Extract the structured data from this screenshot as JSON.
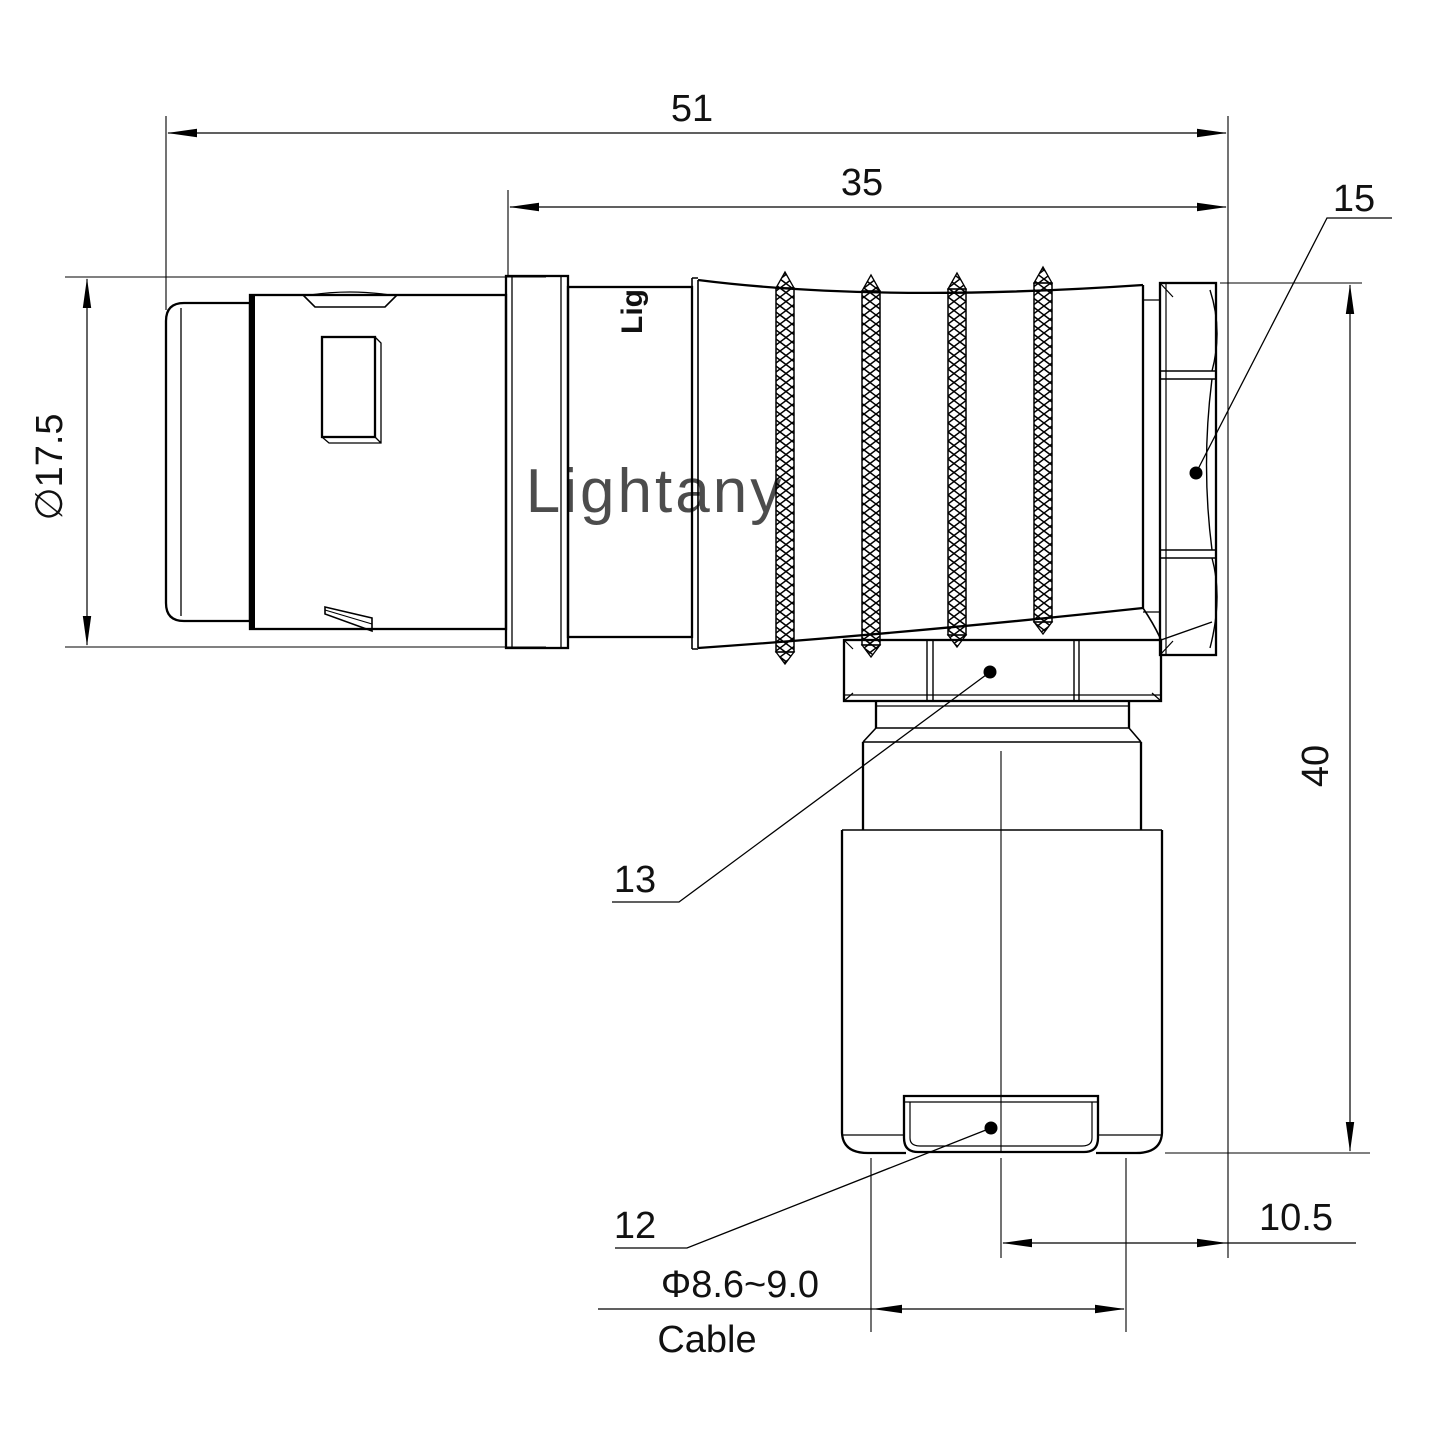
{
  "title": "Right-angle circular connector technical drawing",
  "watermark": "Lightany",
  "body_marking": "Lig",
  "dimensions": {
    "overall_length": "51",
    "rear_length": "35",
    "shell_diameter": "∅17.5",
    "height": "40",
    "axis_offset": "10.5",
    "cable_diameter": "Φ8.6~9.0",
    "cable_caption": "Cable"
  },
  "callouts": {
    "backnut": "15",
    "coupling_nut": "13",
    "cable_clamp": "12"
  },
  "colors": {
    "line": "#000000",
    "text": "#1a1a1a",
    "watermark": "#eeb7bc",
    "background": "#ffffff"
  }
}
